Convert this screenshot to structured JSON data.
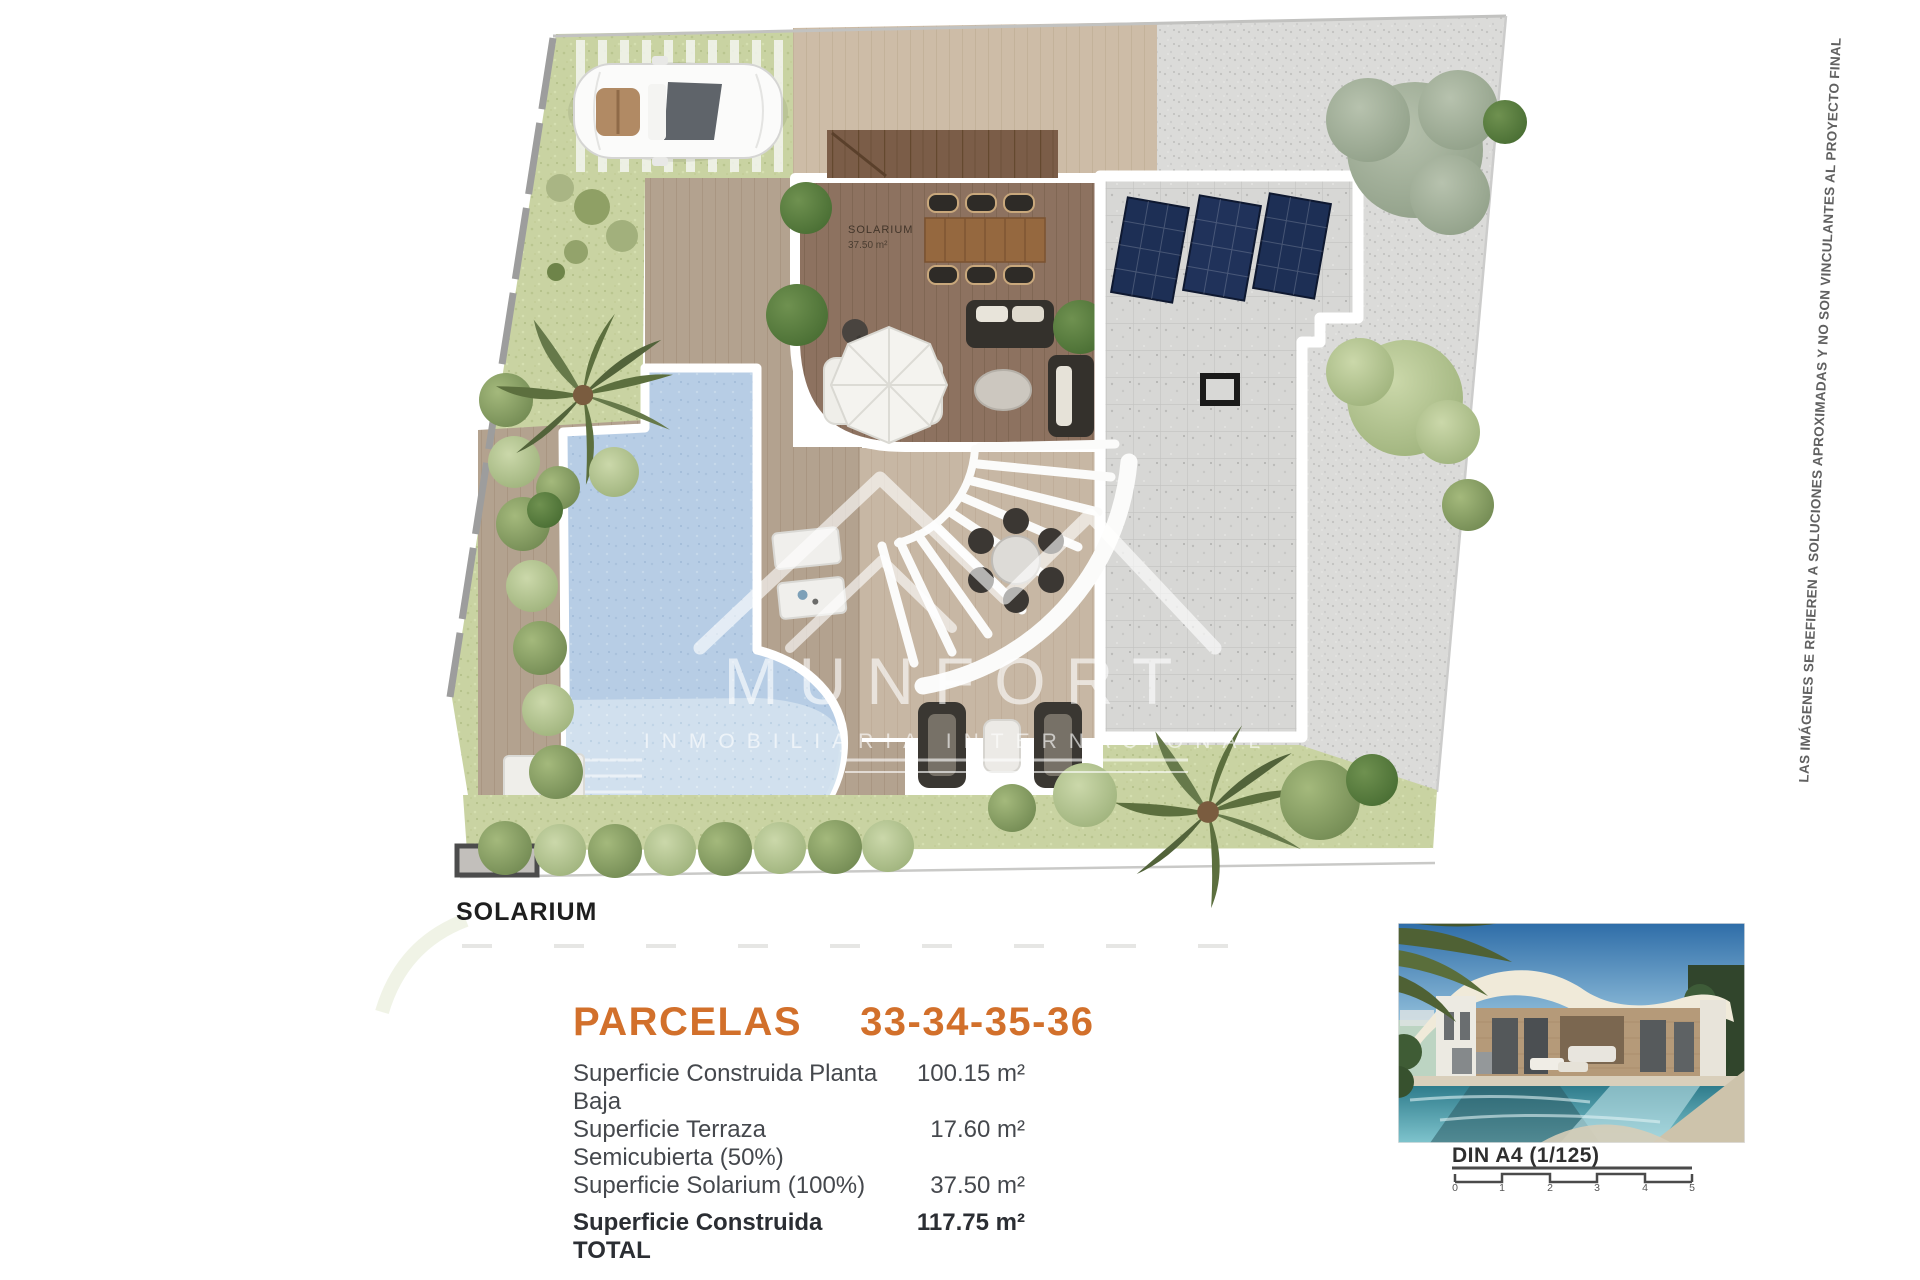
{
  "plan": {
    "caption": "SOLARIUM",
    "deck_label": "SOLARIUM",
    "deck_area": "37.50 m²"
  },
  "watermark": {
    "brand": "MUNFORT",
    "subtitle": "INMOBILIARIA INTERNACIONAL"
  },
  "disclaimer": "LAS IMÁGENES SE REFIEREN A SOLUCIONES APROXIMADAS Y NO SON VINCULANTES AL PROYECTO FINAL",
  "parcel_info": {
    "title": "PARCELAS",
    "numbers": "33-34-35-36",
    "rows": [
      {
        "label": "Superficie Construida Planta Baja",
        "value": "100.15 m²"
      },
      {
        "label": "Superficie Terraza Semicubierta (50%)",
        "value": "17.60 m²"
      },
      {
        "label": "Superficie Solarium (100%)",
        "value": "37.50 m²"
      }
    ],
    "total": {
      "label": "Superficie Construida TOTAL",
      "value": "117.75 m²"
    }
  },
  "scale": {
    "label": "DIN A4 (1/125)",
    "ticks": [
      "0",
      "1",
      "2",
      "3",
      "4",
      "5"
    ]
  },
  "colors": {
    "accent_orange": "#d2702b",
    "pool_blue": "#b7cde5",
    "grass_green": "#c9d3a2",
    "deck_brown": "#b3a28f",
    "solarium_brown": "#8d7260",
    "gravel_grey": "#dcdcda",
    "solar_panel_navy": "#1d2f55"
  }
}
